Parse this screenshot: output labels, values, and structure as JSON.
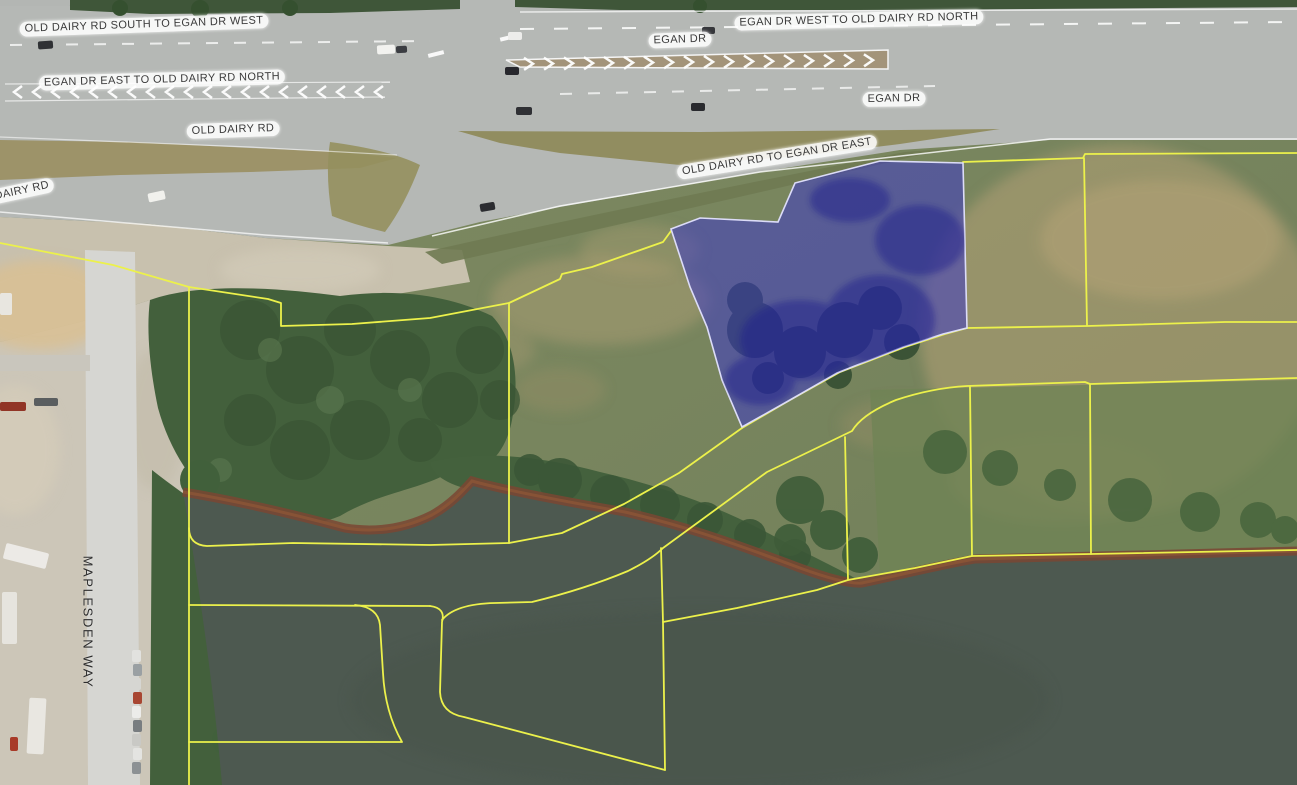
{
  "map": {
    "description": "Aerial parcel map with highlighted parcel near Egan Dr / Old Dairy Rd interchange",
    "road_labels": [
      {
        "id": "old-dairy-south-to-egan-west",
        "text": "OLD DAIRY RD SOUTH TO EGAN DR WEST"
      },
      {
        "id": "egan-east-to-old-dairy-north",
        "text": "EGAN DR EAST TO OLD DAIRY RD NORTH"
      },
      {
        "id": "egan-dr-top",
        "text": "EGAN DR"
      },
      {
        "id": "egan-west-to-old-dairy-north",
        "text": "EGAN DR WEST TO OLD DAIRY RD NORTH"
      },
      {
        "id": "egan-dr-main",
        "text": "EGAN DR"
      },
      {
        "id": "old-dairy-rd",
        "text": "OLD DAIRY RD"
      },
      {
        "id": "old-dairy-partial",
        "text": "DAIRY RD"
      },
      {
        "id": "old-dairy-to-egan-east",
        "text": "OLD DAIRY RD TO EGAN DR EAST"
      },
      {
        "id": "maplesden-way",
        "text": "MAPLESDEN WAY"
      }
    ],
    "colors": {
      "parcel_line": "#ecf14b",
      "selected_parcel_fill": "#3a35c9",
      "selected_parcel_border": "#dcdcf8",
      "water": "#4d5950",
      "shoreline": "#7a4733",
      "road": "#b5b8b5",
      "label_background": "#ffffff"
    }
  }
}
